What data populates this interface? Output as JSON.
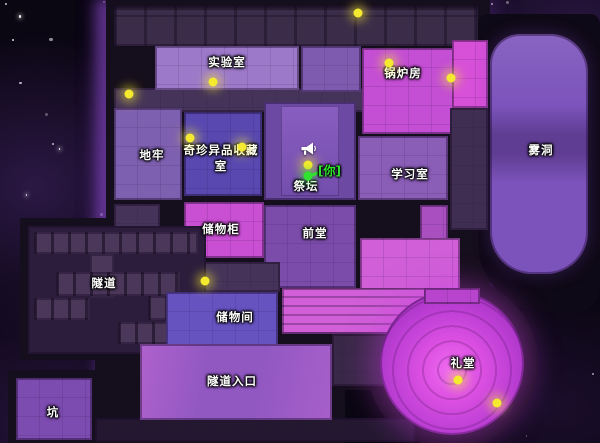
{
  "map": {
    "background_color": "#0a0612",
    "wall_color": "#150e1c",
    "orb_color": "#f4ea30",
    "rooms": [
      {
        "id": "top-corridor",
        "x": 114,
        "y": 6,
        "w": 364,
        "h": 40,
        "bg": "#3b2c49",
        "cls": "pipes",
        "label": ""
      },
      {
        "id": "mid-corridor",
        "x": 114,
        "y": 88,
        "w": 362,
        "h": 24,
        "bg": "#453359",
        "cls": "furn",
        "label": ""
      },
      {
        "id": "laboratory",
        "x": 155,
        "y": 46,
        "w": 144,
        "h": 44,
        "bg": "#9d79ca",
        "cls": "furn",
        "label": "实验室",
        "lx": 227,
        "ly": 62
      },
      {
        "id": "lab-east-room",
        "x": 301,
        "y": 46,
        "w": 60,
        "h": 46,
        "bg": "#7e5bae",
        "cls": "furn",
        "label": ""
      },
      {
        "id": "boiler-room",
        "x": 362,
        "y": 48,
        "w": 94,
        "h": 86,
        "bg": "#c44ed4",
        "cls": "furn",
        "label": "锅炉房",
        "lx": 403,
        "ly": 73
      },
      {
        "id": "northeast-room",
        "x": 452,
        "y": 40,
        "w": 36,
        "h": 68,
        "bg": "#d750d8",
        "cls": "furn",
        "label": ""
      },
      {
        "id": "dungeon",
        "x": 114,
        "y": 108,
        "w": 68,
        "h": 92,
        "bg": "#7e60b0",
        "cls": "furn",
        "label": "地牢",
        "lx": 152,
        "ly": 155
      },
      {
        "id": "curiosities-room",
        "x": 184,
        "y": 112,
        "w": 78,
        "h": 84,
        "bg": "#5948b0",
        "cls": "furn",
        "label": "奇珍异品收藏室",
        "lx": 221,
        "ly": 158,
        "wrap": true
      },
      {
        "id": "altar",
        "x": 264,
        "y": 102,
        "w": 92,
        "h": 98,
        "bg": "#6c4aa4",
        "cls": "altar",
        "label": "祭坛",
        "lx": 306,
        "ly": 186
      },
      {
        "id": "study",
        "x": 358,
        "y": 136,
        "w": 90,
        "h": 64,
        "bg": "#8a5db6",
        "cls": "furn",
        "label": "学习室",
        "lx": 410,
        "ly": 174
      },
      {
        "id": "fog-cave",
        "x": 490,
        "y": 34,
        "w": 98,
        "h": 240,
        "bg": "#7c53bb",
        "cls": "cave",
        "label": "雾洞",
        "lx": 541,
        "ly": 150
      },
      {
        "id": "right-corridor",
        "x": 450,
        "y": 108,
        "w": 38,
        "h": 122,
        "bg": "#3f2d52",
        "cls": "furn",
        "label": ""
      },
      {
        "id": "right-room-a",
        "x": 420,
        "y": 205,
        "w": 28,
        "h": 50,
        "bg": "#a94fc0",
        "cls": "furn",
        "label": ""
      },
      {
        "id": "right-room-b",
        "x": 420,
        "y": 258,
        "w": 30,
        "h": 48,
        "bg": "#cf55c8",
        "cls": "furn",
        "label": ""
      },
      {
        "id": "lockers",
        "x": 184,
        "y": 202,
        "w": 80,
        "h": 56,
        "bg": "#c94fd3",
        "cls": "furn",
        "label": "储物柜",
        "lx": 221,
        "ly": 229
      },
      {
        "id": "foyer",
        "x": 264,
        "y": 205,
        "w": 92,
        "h": 83,
        "bg": "#7b4caa",
        "cls": "furn",
        "label": "前堂",
        "lx": 315,
        "ly": 233
      },
      {
        "id": "left-corridor",
        "x": 114,
        "y": 204,
        "w": 46,
        "h": 60,
        "bg": "#453359",
        "cls": "furn",
        "label": ""
      },
      {
        "id": "lower-left-corridor",
        "x": 158,
        "y": 262,
        "w": 122,
        "h": 30,
        "bg": "#453359",
        "cls": "furn",
        "label": ""
      },
      {
        "id": "tunnel",
        "x": 28,
        "y": 226,
        "w": 178,
        "h": 128,
        "bg": "#2c1d3c",
        "cls": "",
        "label": "隧道",
        "lx": 104,
        "ly": 283
      },
      {
        "id": "tunnel-pass-1",
        "x": 34,
        "y": 232,
        "w": 164,
        "h": 22,
        "bg": "#4a3759",
        "cls": "beams",
        "label": ""
      },
      {
        "id": "tunnel-pass-2",
        "x": 90,
        "y": 254,
        "w": 24,
        "h": 44,
        "bg": "#4a3759",
        "cls": "",
        "label": ""
      },
      {
        "id": "tunnel-pass-3",
        "x": 56,
        "y": 272,
        "w": 124,
        "h": 24,
        "bg": "#4a3759",
        "cls": "beams",
        "label": ""
      },
      {
        "id": "tunnel-pass-4",
        "x": 34,
        "y": 298,
        "w": 56,
        "h": 22,
        "bg": "#4a3759",
        "cls": "beams",
        "label": ""
      },
      {
        "id": "tunnel-pass-5",
        "x": 148,
        "y": 296,
        "w": 52,
        "h": 24,
        "bg": "#4a3759",
        "cls": "beams",
        "label": ""
      },
      {
        "id": "tunnel-pass-6",
        "x": 118,
        "y": 322,
        "w": 88,
        "h": 22,
        "bg": "#4a3759",
        "cls": "beams",
        "label": ""
      },
      {
        "id": "storage-room",
        "x": 166,
        "y": 292,
        "w": 112,
        "h": 54,
        "bg": "#6753c0",
        "cls": "furn",
        "label": "储物间",
        "lx": 235,
        "ly": 317
      },
      {
        "id": "hall-right",
        "x": 360,
        "y": 238,
        "w": 100,
        "h": 96,
        "bg": "#d05fd8",
        "cls": "furn",
        "label": ""
      },
      {
        "id": "hall-lower",
        "x": 282,
        "y": 288,
        "w": 178,
        "h": 46,
        "bg": "#d05fd8",
        "cls": "shelves",
        "label": ""
      },
      {
        "id": "chapel-corridor",
        "x": 332,
        "y": 334,
        "w": 84,
        "h": 52,
        "bg": "#3a2848",
        "cls": "furn",
        "label": ""
      },
      {
        "id": "bottom-corridor",
        "x": 95,
        "y": 418,
        "w": 320,
        "h": 24,
        "bg": "#241831",
        "cls": "furn",
        "label": ""
      },
      {
        "id": "tunnel-entrance",
        "x": 140,
        "y": 344,
        "w": 192,
        "h": 76,
        "bg": "#9158c2",
        "cls": "entrance",
        "label": "隧道入口",
        "lx": 232,
        "ly": 381
      },
      {
        "id": "pit",
        "x": 16,
        "y": 378,
        "w": 76,
        "h": 62,
        "bg": "#7d4cb0",
        "cls": "furn",
        "label": "坑",
        "lx": 53,
        "ly": 412
      },
      {
        "id": "chapel",
        "x": 380,
        "y": 291,
        "w": 144,
        "h": 144,
        "bg": "",
        "cls": "chapel",
        "label": "礼堂",
        "lx": 463,
        "ly": 363
      },
      {
        "id": "chapel-stage",
        "x": 424,
        "y": 288,
        "w": 56,
        "h": 16,
        "bg": "#b843cc",
        "cls": "furn",
        "label": ""
      }
    ],
    "orbs": [
      {
        "x": 213,
        "y": 82
      },
      {
        "x": 358,
        "y": 13
      },
      {
        "x": 389,
        "y": 63
      },
      {
        "x": 451,
        "y": 78
      },
      {
        "x": 129,
        "y": 94
      },
      {
        "x": 190,
        "y": 138
      },
      {
        "x": 242,
        "y": 147
      },
      {
        "x": 308,
        "y": 165
      },
      {
        "x": 205,
        "y": 281
      },
      {
        "x": 458,
        "y": 380
      },
      {
        "x": 497,
        "y": 403
      }
    ],
    "player": {
      "x": 308,
      "y": 176,
      "label": "[你]",
      "color": "#2ee42e",
      "name_x": 318,
      "name_y": 170
    },
    "icons": [
      {
        "name": "megaphone-icon",
        "x": 308,
        "y": 151
      }
    ]
  }
}
